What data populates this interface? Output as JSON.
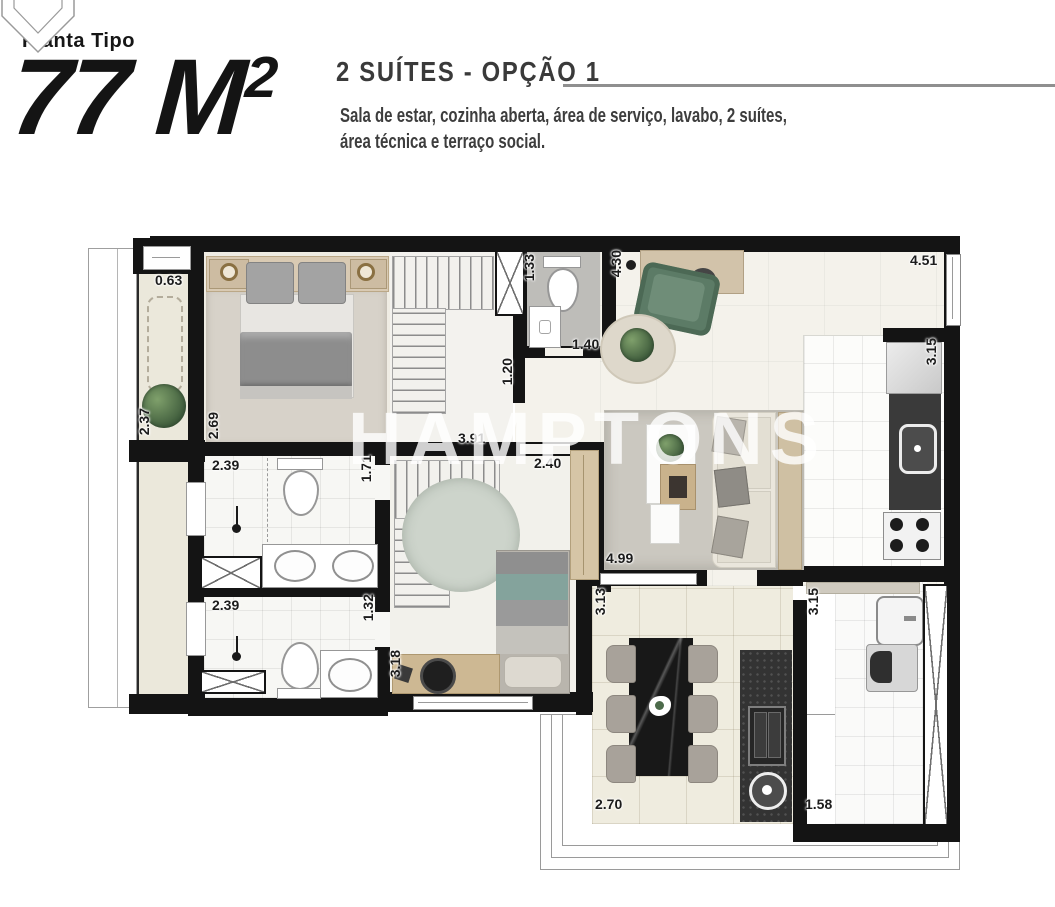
{
  "header": {
    "eyebrow": "Planta Tipo",
    "area_value": "77 M",
    "area_exponent": "2",
    "option_title": "2 SUÍTES - OPÇÃO 1",
    "description_line1": "Sala de estar, cozinha aberta, área de serviço, lavabo, 2 suítes,",
    "description_line2": "área técnica e terraço social."
  },
  "watermark": "HAMPTONS",
  "dims": {
    "balcony_width": "0.63",
    "balcony_depth": "2.37",
    "suite1_depth": "2.69",
    "bath1_width": "2.39",
    "bath1_depth": "1.71",
    "suite2_width": "3.91",
    "suite2_entry": "2.40",
    "lavabo_width": "1.33",
    "lavabo_depth": "1.40",
    "hall_width": "1.20",
    "sala_depth": "4.30",
    "sala_width": "4.51",
    "kitchen_depth": "3.15",
    "living_width": "4.99",
    "dining_depth": "3.13",
    "service_depth": "3.15",
    "bath2_width": "2.39",
    "bath2_depth": "1.32",
    "suite2_depth": "3.18",
    "dining_width": "2.70",
    "service_width": "1.58"
  },
  "colors": {
    "wall": "#141414",
    "wood": "#d2c2a6",
    "armchair_green": "#5c7b66",
    "bed_teal": "#84a39c"
  }
}
